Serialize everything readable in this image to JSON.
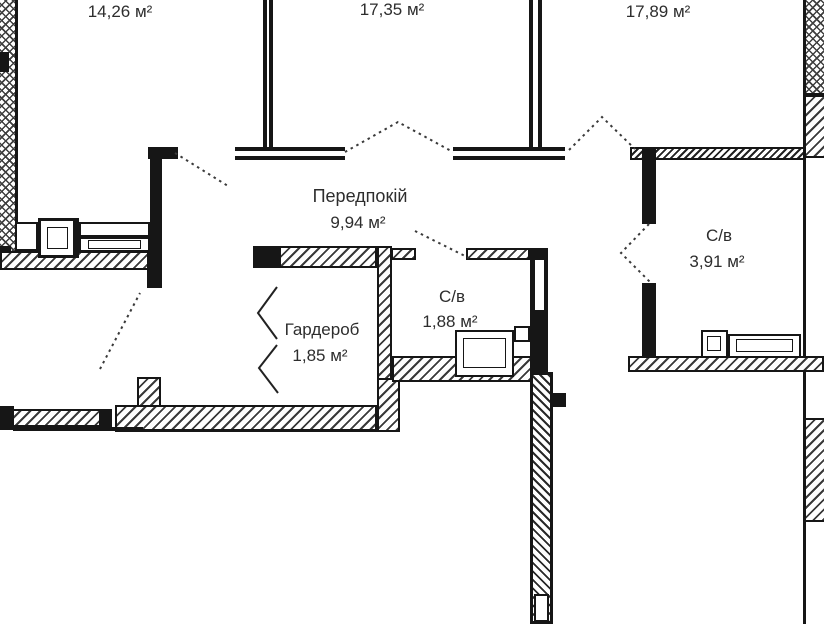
{
  "colors": {
    "background": "#ffffff",
    "line": "#161616",
    "text": "#2d2d2d"
  },
  "rooms": {
    "top_left": {
      "area": "14,26 м²"
    },
    "top_middle": {
      "area": "17,35 м²"
    },
    "top_right": {
      "area": "17,89 м²"
    },
    "hallway": {
      "name": "Передпокій",
      "area": "9,94 м²"
    },
    "bathroom_center": {
      "name": "С/в",
      "area": "1,88 м²"
    },
    "bathroom_right": {
      "name": "С/в",
      "area": "3,91 м²"
    },
    "wardrobe": {
      "name": "Гардероб",
      "area": "1,85 м²"
    }
  }
}
